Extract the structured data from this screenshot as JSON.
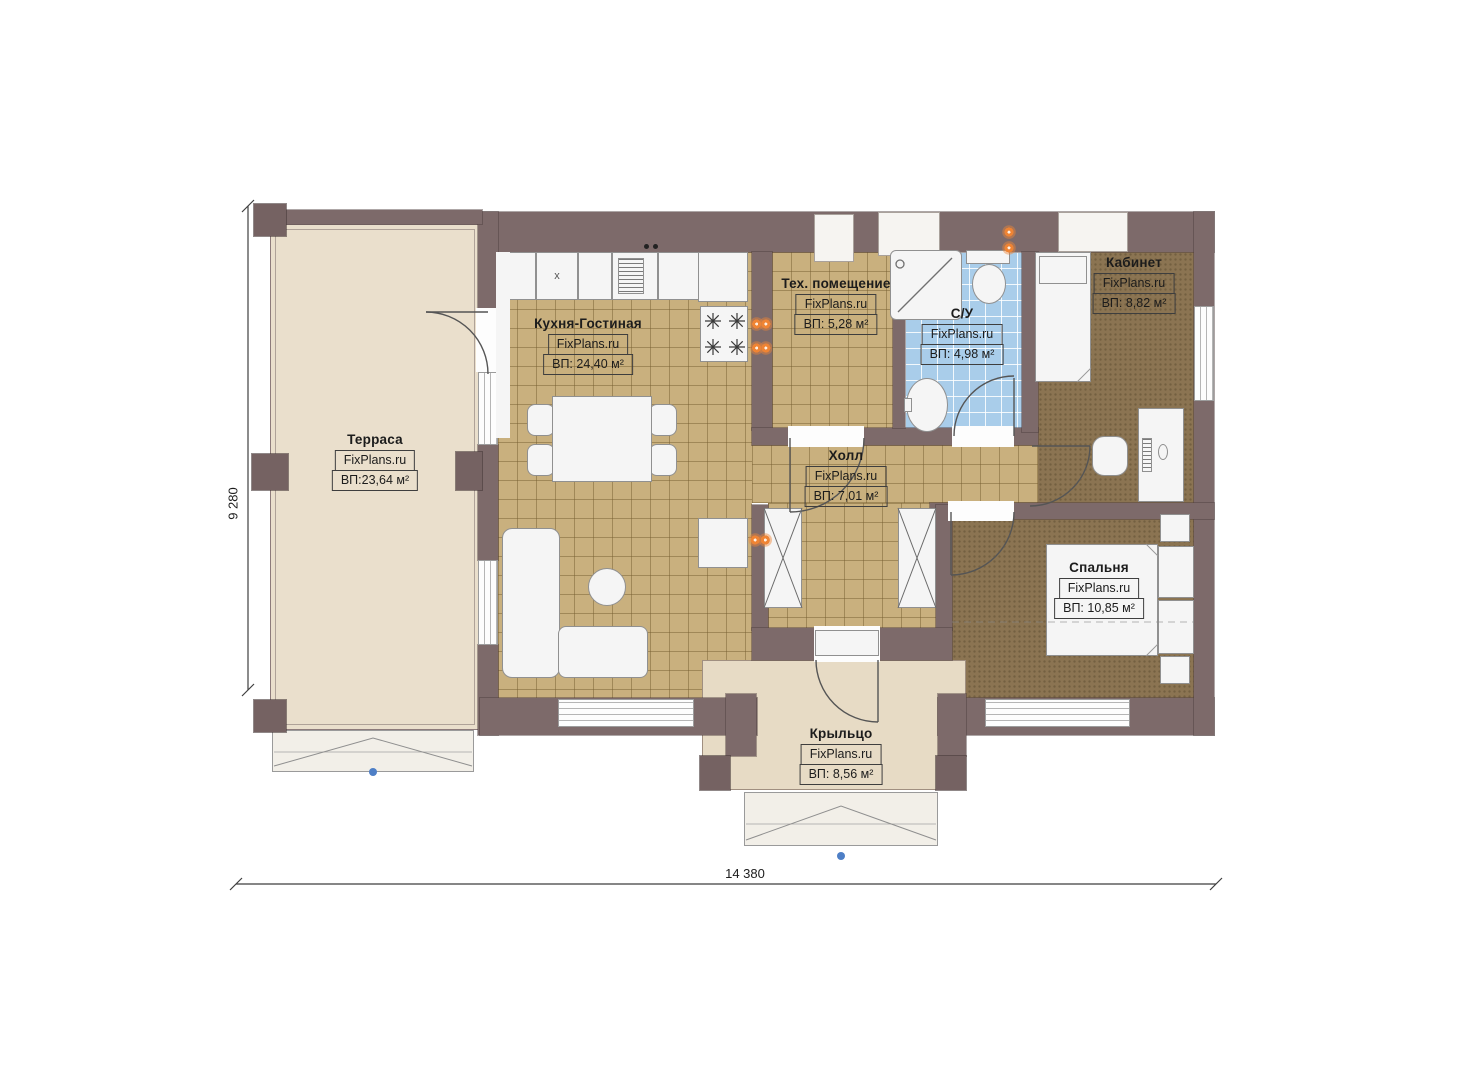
{
  "watermark": "FixPlans.ru",
  "dimensions": {
    "width_label": "14 380",
    "height_label": "9 280"
  },
  "rooms": [
    {
      "id": "terrace",
      "name": "Терраса",
      "area": "ВП:23,64 м²"
    },
    {
      "id": "kitchen-living",
      "name": "Кухня-Гостиная",
      "area": "ВП: 24,40 м²"
    },
    {
      "id": "tech-room",
      "name": "Тех. помещение",
      "area": "ВП: 5,28 м²"
    },
    {
      "id": "bathroom",
      "name": "С/У",
      "area": "ВП: 4,98 м²"
    },
    {
      "id": "office",
      "name": "Кабинет",
      "area": "ВП: 8,82 м²"
    },
    {
      "id": "hall",
      "name": "Холл",
      "area": "ВП: 7,01 м²"
    },
    {
      "id": "bedroom",
      "name": "Спальня",
      "area": "ВП: 10,85 м²"
    },
    {
      "id": "porch",
      "name": "Крыльцо",
      "area": "ВП: 8,56 м²"
    }
  ],
  "kitchen": {
    "cabinet_mark": "x"
  },
  "colors": {
    "wall": "#7d6a6a",
    "tile_tan": "#c9b07e",
    "tile_blue": "#a9cdea",
    "carpet": "#8b7452",
    "terrace_floor": "#eadfcc",
    "porch_floor": "#e7dbc5",
    "radiator_orange": "#ef8434",
    "marker_blue": "#4e7fc6"
  }
}
